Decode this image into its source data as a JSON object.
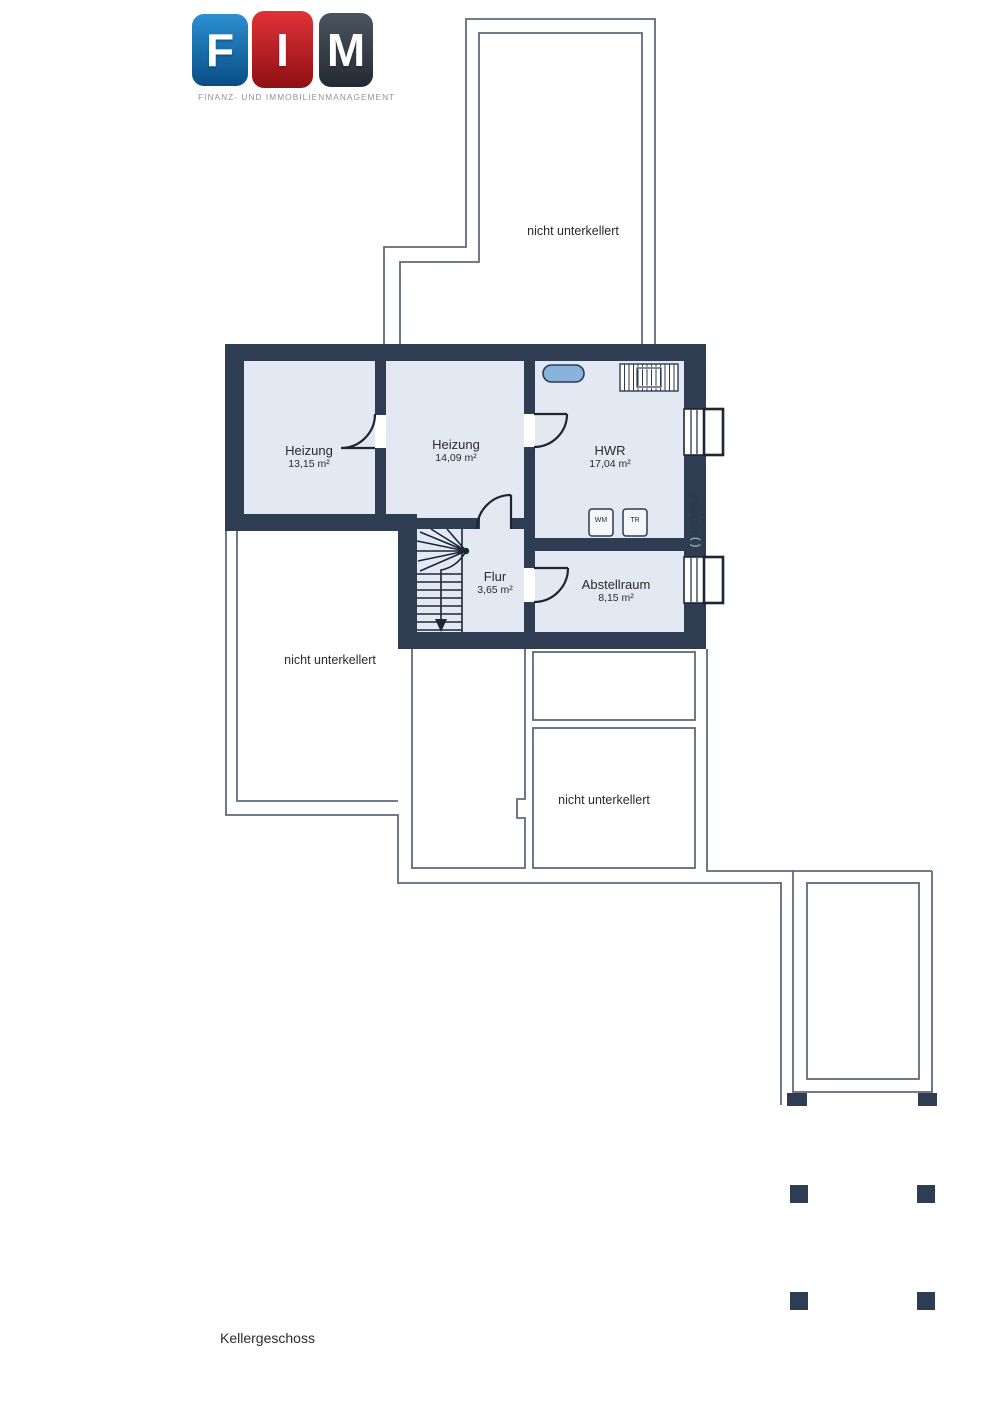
{
  "logo": {
    "letters": [
      "F",
      "I",
      "M"
    ],
    "tagline": "FINANZ- UND IMMOBILIENMANAGEMENT",
    "colors": {
      "f_block": "#1a7fc4",
      "i_block": "#c81e24",
      "m_block": "#3a4450",
      "tagline": "#8d939c"
    }
  },
  "plan": {
    "floor_label": "Kellergeschoss",
    "rooms": [
      {
        "name": "Heizung",
        "area": "13,15 m²"
      },
      {
        "name": "Heizung",
        "area": "14,09 m²"
      },
      {
        "name": "HWR",
        "area": "17,04 m²"
      },
      {
        "name": "Flur",
        "area": "3,65 m²"
      },
      {
        "name": "Abstellraum",
        "area": "8,15 m²"
      }
    ],
    "appliances": [
      {
        "label": "WM"
      },
      {
        "label": "TR"
      }
    ],
    "annotations": {
      "not_basemented": "nicht unterkellert"
    },
    "colors": {
      "wall": "#2e3d52",
      "room_fill": "#e3e9f2",
      "outline": "#5f6a7a",
      "sink": "#8ab3dc",
      "text": "#2b2b2b"
    }
  },
  "watermark": {
    "prefix": "( )",
    "brand": "onOffice",
    "sub": "software"
  }
}
